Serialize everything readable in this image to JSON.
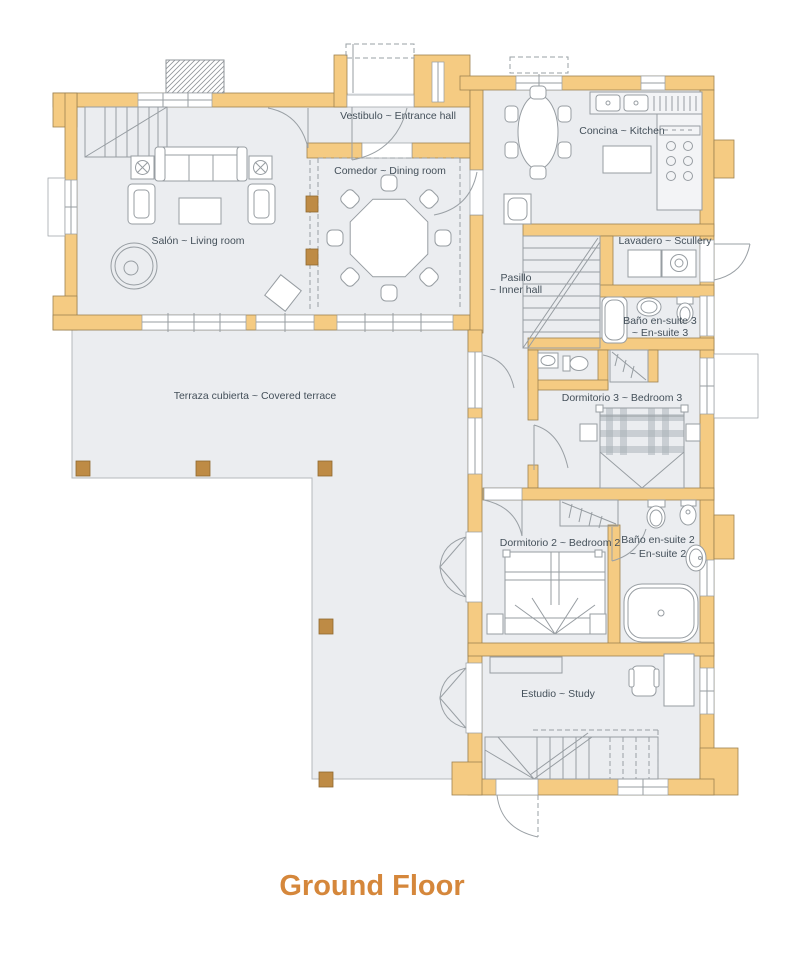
{
  "title": "Ground Floor",
  "colors": {
    "wall": "#F5CB82",
    "pillar": "#BE8B45",
    "floor": "#EBEDF0",
    "line": "#979DA2",
    "label_text": "#44505A",
    "title_text": "#D5873B",
    "background": "#FFFFFF"
  },
  "rooms": {
    "vestibulo": {
      "label": "Vestibulo ~ Entrance hall"
    },
    "cocina": {
      "label": "Concina ~ Kitchen"
    },
    "comedor": {
      "label": "Comedor ~ Dining room"
    },
    "salon": {
      "label": "Salón ~ Living room"
    },
    "lavadero": {
      "label": "Lavadero ~ Scullery"
    },
    "pasillo": {
      "line1": "Pasillo",
      "line2": "~ Inner hall"
    },
    "bano3": {
      "line1": "Baño en-suite 3",
      "line2": "~ En-suite 3"
    },
    "dormitorio3": {
      "label": "Dormitorio 3 ~ Bedroom 3"
    },
    "terraza": {
      "label": "Terraza cubierta ~ Covered terrace"
    },
    "dormitorio2": {
      "label": "Dormitorio 2 ~ Bedroom 2"
    },
    "bano2": {
      "line1": "Baño en-suite 2",
      "line2": "~ En-suite 2"
    },
    "estudio": {
      "label": "Estudio ~ Study"
    }
  }
}
